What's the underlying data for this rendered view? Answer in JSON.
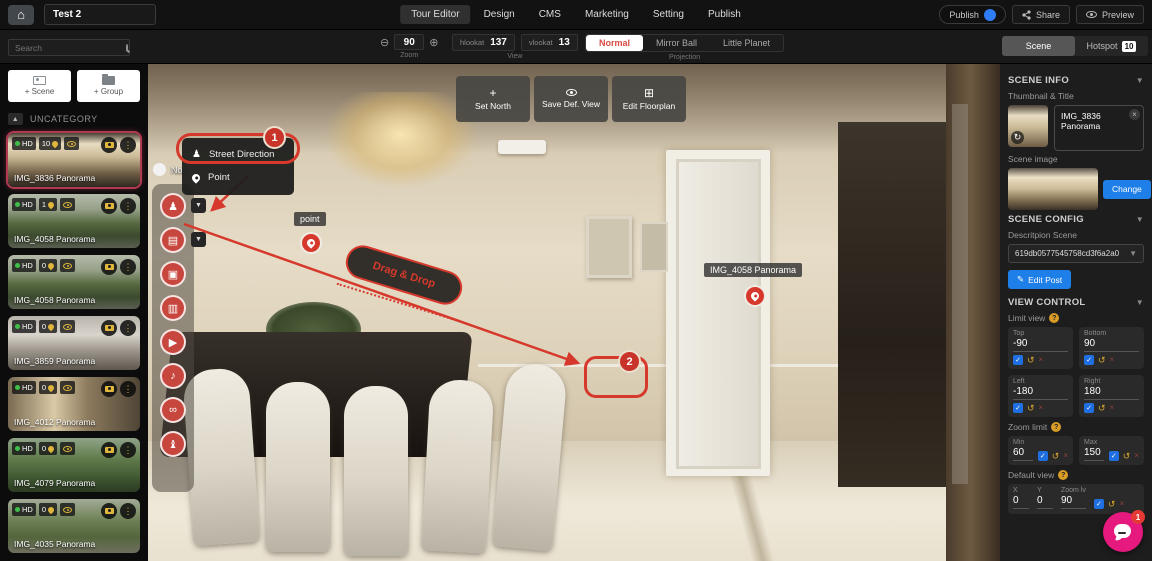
{
  "topbar": {
    "title_value": "Test 2",
    "tabs": [
      {
        "label": "Tour Editor",
        "active": true
      },
      {
        "label": "Design",
        "active": false
      },
      {
        "label": "CMS",
        "active": false
      },
      {
        "label": "Marketing",
        "active": false
      },
      {
        "label": "Setting",
        "active": false
      },
      {
        "label": "Publish",
        "active": false
      }
    ],
    "publish_toggle_label": "Publish",
    "share_label": "Share",
    "preview_label": "Preview"
  },
  "toolbar": {
    "search_placeholder": "Search",
    "zoom_group": {
      "value": "90",
      "caption": "Zoom"
    },
    "view_group": {
      "hlookat_label": "hlookat",
      "hlookat_value": "137",
      "vlookat_label": "vlookat",
      "vlookat_value": "13",
      "caption": "View"
    },
    "projection_group": {
      "options": [
        "Normal",
        "Mirror Ball",
        "Little Planet"
      ],
      "active_index": 0,
      "caption": "Projection"
    },
    "panel_tabs": {
      "scene_label": "Scene",
      "hotspot_label": "Hotspot",
      "hotspot_count": "10"
    }
  },
  "sidebar": {
    "add_scene_label": "+ Scene",
    "add_group_label": "+ Group",
    "category_label": "UNCATEGORY",
    "scenes": [
      {
        "name": "IMG_3836 Panorama",
        "quality": "HD",
        "hotspot_count": "10",
        "selected": true
      },
      {
        "name": "IMG_4058 Panorama",
        "quality": "HD",
        "hotspot_count": "1",
        "selected": false
      },
      {
        "name": "IMG_4058 Panorama",
        "quality": "HD",
        "hotspot_count": "0",
        "selected": false
      },
      {
        "name": "IMG_3859 Panorama",
        "quality": "HD",
        "hotspot_count": "0",
        "selected": false
      },
      {
        "name": "IMG_4012 Panorama",
        "quality": "HD",
        "hotspot_count": "0",
        "selected": false
      },
      {
        "name": "IMG_4079 Panorama",
        "quality": "HD",
        "hotspot_count": "0",
        "selected": false
      },
      {
        "name": "IMG_4035 Panorama",
        "quality": "HD",
        "hotspot_count": "0",
        "selected": false
      }
    ]
  },
  "canvas": {
    "top_buttons": [
      {
        "label": "Set North",
        "icon": "compass-icon",
        "glyph": "+"
      },
      {
        "label": "Save Def. View",
        "icon": "eye-icon",
        "glyph": "eye"
      },
      {
        "label": "Edit Floorplan",
        "icon": "floorplan-icon",
        "glyph": "⊞"
      }
    ],
    "north_toggle_label": "Nor",
    "hotspot_menu": {
      "items": [
        {
          "label": "Street Direction",
          "icon": "street-direction-icon"
        },
        {
          "label": "Point",
          "icon": "point-pin-icon"
        }
      ]
    },
    "hotspot_toolbar": [
      {
        "name": "street-direction-hotspot",
        "glyph": "♟",
        "has_chevron": true
      },
      {
        "name": "card-hotspot",
        "glyph": "▤",
        "has_chevron": true
      },
      {
        "name": "image-hotspot",
        "glyph": "▣",
        "has_chevron": false
      },
      {
        "name": "article-hotspot",
        "glyph": "▥",
        "has_chevron": false
      },
      {
        "name": "video-hotspot",
        "glyph": "▶",
        "has_chevron": false
      },
      {
        "name": "audio-hotspot",
        "glyph": "♪",
        "has_chevron": false
      },
      {
        "name": "link-hotspot",
        "glyph": "∞",
        "has_chevron": false
      },
      {
        "name": "product-hotspot",
        "glyph": "♝",
        "has_chevron": false
      }
    ],
    "annotations": {
      "step_1": "1",
      "step_2": "2",
      "drag_drop_label": "Drag & Drop"
    },
    "hotspots": {
      "point_label": "point",
      "scene_link_label": "IMG_4058 Panorama"
    }
  },
  "inspector": {
    "scene_info": {
      "header": "SCENE INFO",
      "thumbnail_title_label": "Thumbnail & Title",
      "scene_title_value": "IMG_3836 Panorama",
      "scene_image_label": "Scene image",
      "change_button": "Change"
    },
    "scene_config": {
      "header": "SCENE CONFIG",
      "description_label": "Descritpion Scene",
      "post_id_value": "619db0577545758cd3f6a2a0",
      "edit_post_button": "Edit Post"
    },
    "view_control": {
      "header": "VIEW CONTROL",
      "limit_view_label": "Limit view",
      "limits": [
        {
          "label": "Top",
          "value": "-90"
        },
        {
          "label": "Bottom",
          "value": "90"
        },
        {
          "label": "Left",
          "value": "-180"
        },
        {
          "label": "Right",
          "value": "180"
        }
      ],
      "zoom_limit_label": "Zoom limit",
      "zoom_limits": [
        {
          "label": "Min",
          "value": "60"
        },
        {
          "label": "Max",
          "value": "150"
        }
      ],
      "default_view_label": "Default view",
      "default_view": [
        {
          "label": "X",
          "value": "0"
        },
        {
          "label": "Y",
          "value": "0"
        },
        {
          "label": "Zoom lv",
          "value": "90"
        }
      ]
    }
  },
  "chat_widget": {
    "unread_count": "1"
  },
  "colors": {
    "annotation_red": "#d6392c",
    "hotspot_red": "#c7463e",
    "primary_blue": "#1f7fe8",
    "toggle_blue": "#2f7df6",
    "projection_active_text": "#d84a42",
    "checkbox_blue": "#1f6fe0",
    "selected_scene_border": "#b03a50",
    "chat_pink": "#e6197e",
    "badge_yellow": "#e0b63c",
    "hd_green": "#3fbf4a"
  }
}
